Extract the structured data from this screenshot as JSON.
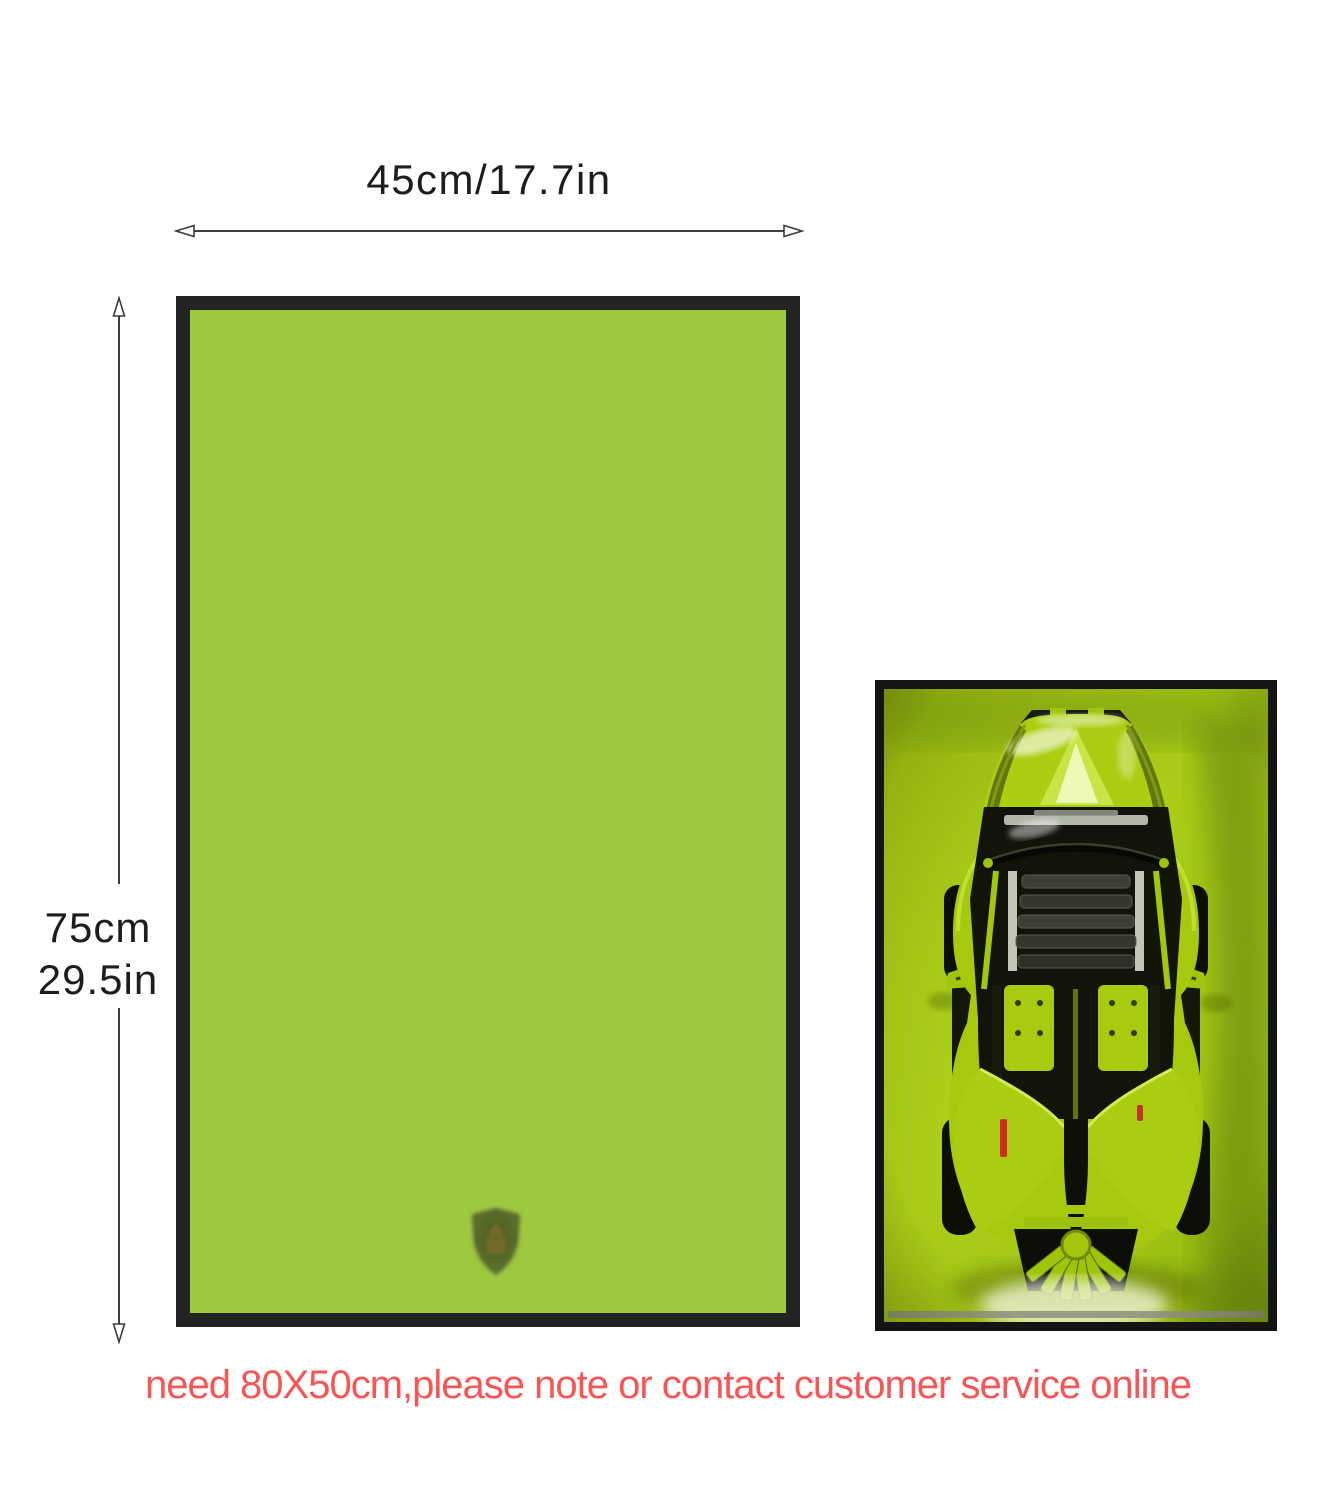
{
  "product_diagram": {
    "width_label": "45cm/17.7in",
    "height_label_line1": "75cm",
    "height_label_line2": "29.5in",
    "note_text": "need 80X50cm,please note or contact customer service online"
  },
  "icons": {
    "display_case_logo": "lamborghini-shield-watermark",
    "product_photo_subject": "lego-technic-lamborghini-wall-frame-top-view",
    "dimension_arrows": [
      "width-double-arrow",
      "height-double-arrow"
    ]
  },
  "colors": {
    "case_green": "#9cc93e",
    "case_frame_black": "#232323",
    "photo_frame_black": "#141414",
    "photo_background_green": "#a6c911",
    "car_lime_green": "#aed111",
    "note_red": "#f85555",
    "dimension_text": "#1d1d1d"
  }
}
